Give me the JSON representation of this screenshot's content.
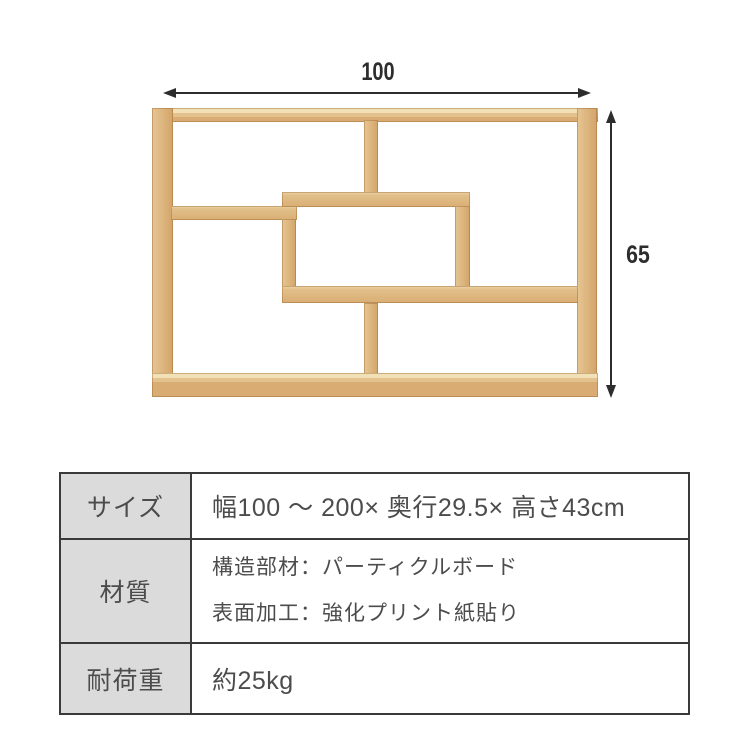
{
  "page": {
    "background": "#ffffff"
  },
  "diagram": {
    "width_label": "100",
    "height_label": "65",
    "arrow_color": "#2d2d2d",
    "wood_face_color": "#dcb47d",
    "wood_top_color": "#ecd6a8",
    "wood_edge_color": "#b9854d"
  },
  "spec_table": {
    "header_bg": "#dbdbdb",
    "border_color": "#3a3a3a",
    "text_color": "#4c4c4c",
    "rows": [
      {
        "label": "サイズ",
        "lines": [
          "幅100 ～ 200× 奥行29.5× 高さ43cm"
        ]
      },
      {
        "label": "材質",
        "lines": [
          "構造部材：パーティクルボード",
          "表面加工：強化プリント紙貼り"
        ]
      },
      {
        "label": "耐荷重",
        "lines": [
          "約25kg"
        ]
      }
    ]
  }
}
